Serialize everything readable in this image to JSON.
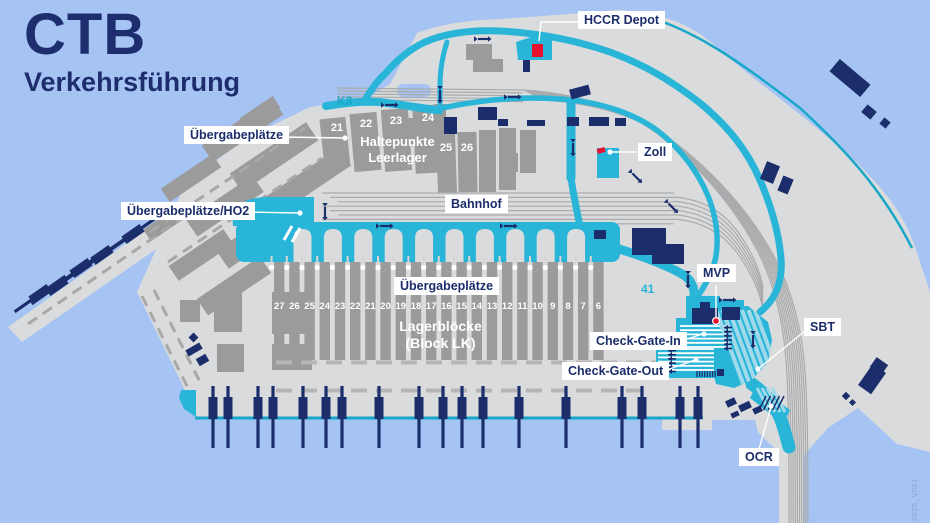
{
  "title": {
    "main": "CTB",
    "subtitle": "Verkehrsführung"
  },
  "labels": {
    "hccr_depot": "HCCR Depot",
    "uebergabeplaetze_left": "Übergabeplätze",
    "uebergabeplaetze_ho2": "Übergabeplätze/HO2",
    "haltepunkte_line1": "Haltepunkte",
    "haltepunkte_line2": "Leerlager",
    "zoll": "Zoll",
    "bahnhof": "Bahnhof",
    "uebergabeplaetze_center": "Übergabeplätze",
    "lagerbloecke_line1": "Lagerblöcke",
    "lagerbloecke_line2": "(Block LK)",
    "mvp": "MVP",
    "sbt": "SBT",
    "check_gate_in": "Check-Gate-In",
    "check_gate_out": "Check-Gate-Out",
    "ocr": "OCR",
    "k3": "K3",
    "area_41": "41",
    "version": "2025_V001"
  },
  "haltepunkte_numbers": [
    "21",
    "22",
    "23",
    "24",
    "25",
    "26"
  ],
  "block_numbers": [
    "27",
    "26",
    "25",
    "24",
    "23",
    "22",
    "21",
    "20",
    "19",
    "18",
    "17",
    "16",
    "15",
    "14",
    "13",
    "12",
    "11",
    "10",
    "9",
    "8",
    "7",
    "6"
  ],
  "colors": {
    "water": "#a5c3f3",
    "land": "#dadbdc",
    "building_gray": "#9b9b9b",
    "rail": "#aaabad",
    "road_cyan": "#29b5d8",
    "road_light": "#9fd9ea",
    "coast_teal": "#18a7c8",
    "navy": "#1b2d6b",
    "red": "#e8112d"
  }
}
